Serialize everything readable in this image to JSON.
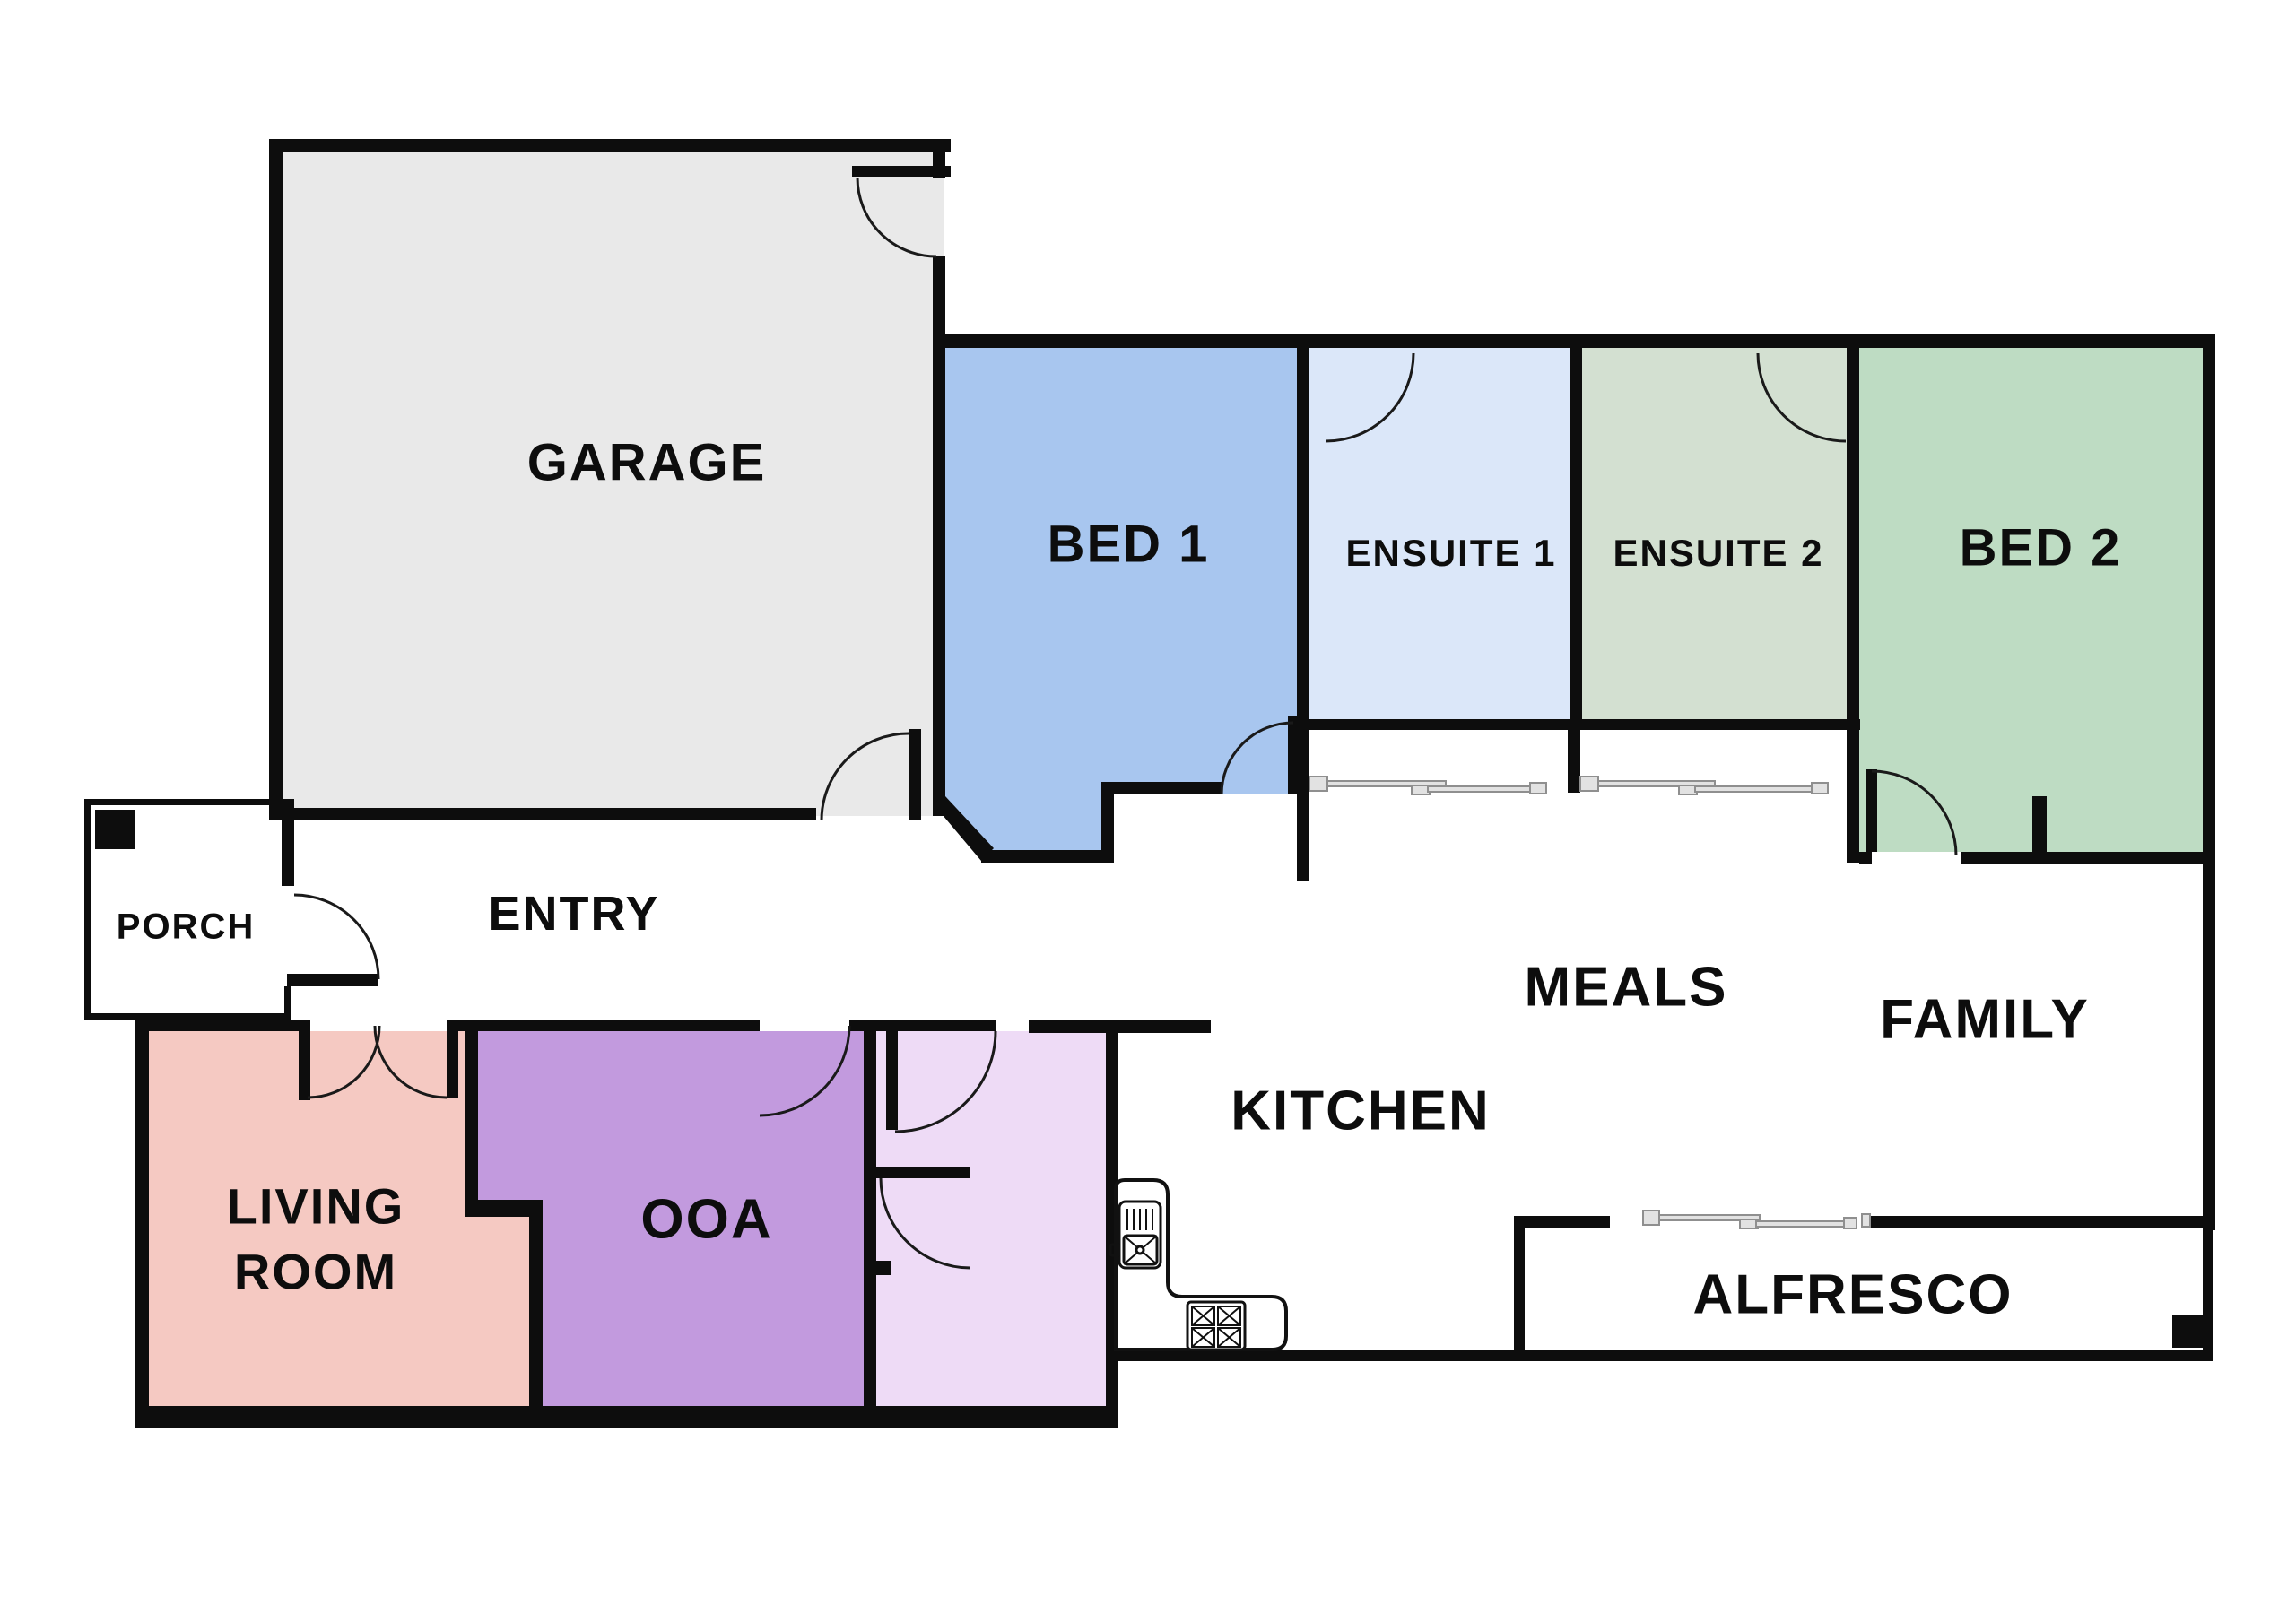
{
  "plan": {
    "background": "#ffffff",
    "wall_color": "#0d0d0d",
    "door_arc_color": "#1a1a1a",
    "window_rail_fill": "#e2e2e2",
    "window_rail_edge": "#8f8f8f",
    "rooms": [
      {
        "id": "garage",
        "label": "GARAGE",
        "fill": "#e9e9e9"
      },
      {
        "id": "bed1",
        "label": "BED 1",
        "fill": "#a8c6ef"
      },
      {
        "id": "ensuite1",
        "label": "ENSUITE 1",
        "fill": "#dbe7f9"
      },
      {
        "id": "ensuite2",
        "label": "ENSUITE 2",
        "fill": "#d3e0d1"
      },
      {
        "id": "bed2",
        "label": "BED 2",
        "fill": "#bedcc3"
      },
      {
        "id": "porch",
        "label": "PORCH",
        "fill": "#ffffff"
      },
      {
        "id": "entry",
        "label": "ENTRY",
        "fill": "#ffffff"
      },
      {
        "id": "meals",
        "label": "MEALS",
        "fill": "#ffffff"
      },
      {
        "id": "family",
        "label": "FAMILY",
        "fill": "#ffffff"
      },
      {
        "id": "kitchen",
        "label": "KITCHEN",
        "fill": "#ffffff"
      },
      {
        "id": "living",
        "label": "LIVING ROOM",
        "fill": "#f5c9c2"
      },
      {
        "id": "ooa",
        "label": "OOA",
        "fill": "#c29ade"
      },
      {
        "id": "alfresco",
        "label": "ALFRESCO",
        "fill": "#ffffff"
      }
    ],
    "labels": {
      "living_line1": "LIVING",
      "living_line2": "ROOM"
    }
  }
}
